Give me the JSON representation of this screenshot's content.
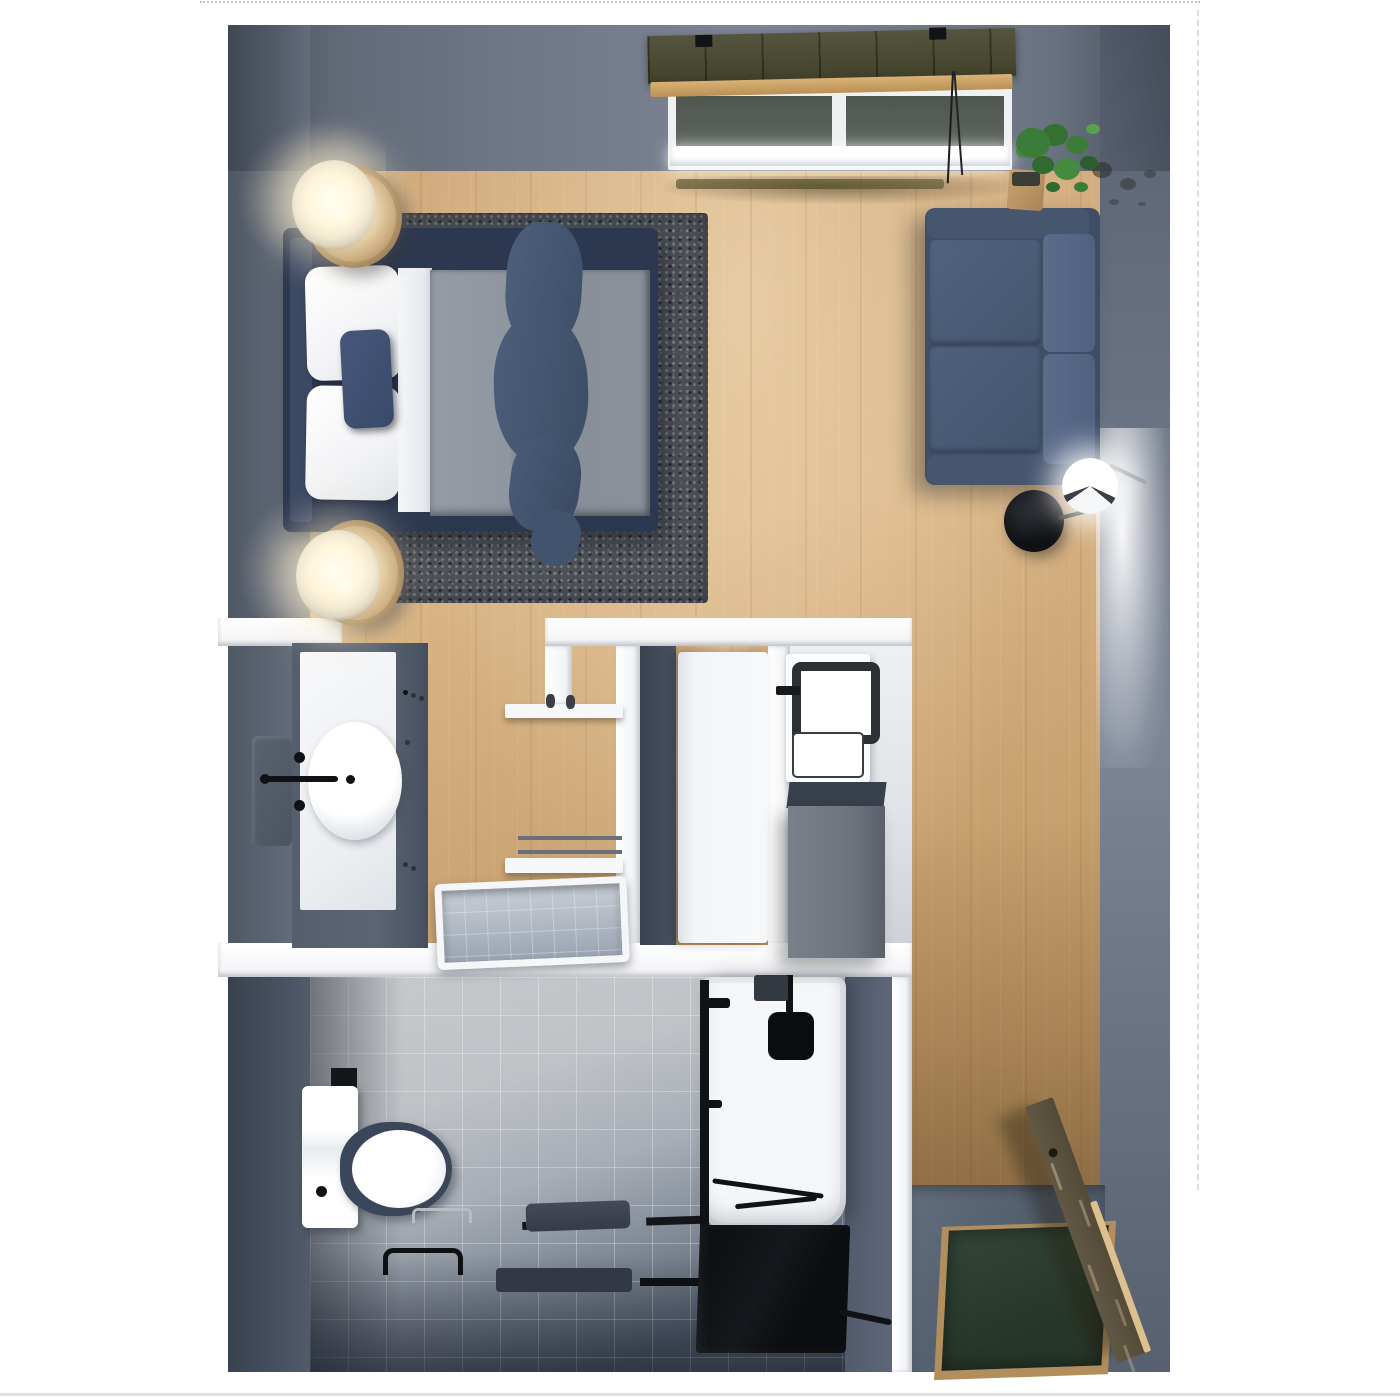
{
  "app": {
    "view_type": "3d-floor-plan-top-view",
    "subject": "studio-apartment-render",
    "visible_text": "none"
  },
  "palette": {
    "wall": "#6b7484",
    "wallDeep": "#4b5565",
    "wallInner": "#57616f",
    "wood": "#cfa97b",
    "woodDeep": "#b18a58",
    "rug": "#4d5158",
    "navy": "#2c3850",
    "blanket": "#8f959e",
    "sheet": "#eef0f3",
    "pillow": "#f5f6f8",
    "accentPillow": "#3d4e6a",
    "throw": "#46586f",
    "sofaBase": "#3f4e66",
    "sofaSeat": "#4a5c78",
    "sofaBack": "#566886",
    "counter": "#f2f4f6",
    "tileDark": "#4c576a",
    "matGreen": "#2c4033",
    "matBorder": "#b28e5c",
    "door": "#5b5240",
    "doorEdge": "#dcc08d",
    "black": "#101215",
    "blind": "#4c4c3a",
    "blindRail": "#cda26b",
    "cabinet": "#6f757e",
    "cabinetTop": "#39404d",
    "glassPane": "#5a615b",
    "plant": "#3c7c39",
    "lampGlow": "#fff3d2"
  },
  "rooms": [
    {
      "name": "bedroom-living-area",
      "floor": "wood"
    },
    {
      "name": "vanity-area",
      "floor": "slate"
    },
    {
      "name": "hallway",
      "floor": "wood"
    },
    {
      "name": "closet",
      "floor": "wood"
    },
    {
      "name": "laundry-nook",
      "floor": "white"
    },
    {
      "name": "bathroom",
      "floor": "tile"
    },
    {
      "name": "entry",
      "floor": "slate"
    }
  ],
  "furniture": [
    "window-with-blinds",
    "double-bed",
    "area-rug",
    "nightstand-top",
    "table-lamp-top",
    "nightstand-bottom",
    "table-lamp-bottom",
    "loveseat-sofa",
    "potted-plant",
    "floor-lamp",
    "wall-sconce",
    "vanity-cabinet",
    "vessel-sink",
    "faucet",
    "mirror",
    "wall-shelf-upper",
    "wall-shelf-lower",
    "bathtub",
    "closet-door",
    "washing-machine",
    "storage-cabinet",
    "toilet",
    "grab-bar",
    "towel",
    "bath-mat",
    "shower-tray",
    "shower-head",
    "shower-glass-panel",
    "entry-door",
    "doormat"
  ]
}
